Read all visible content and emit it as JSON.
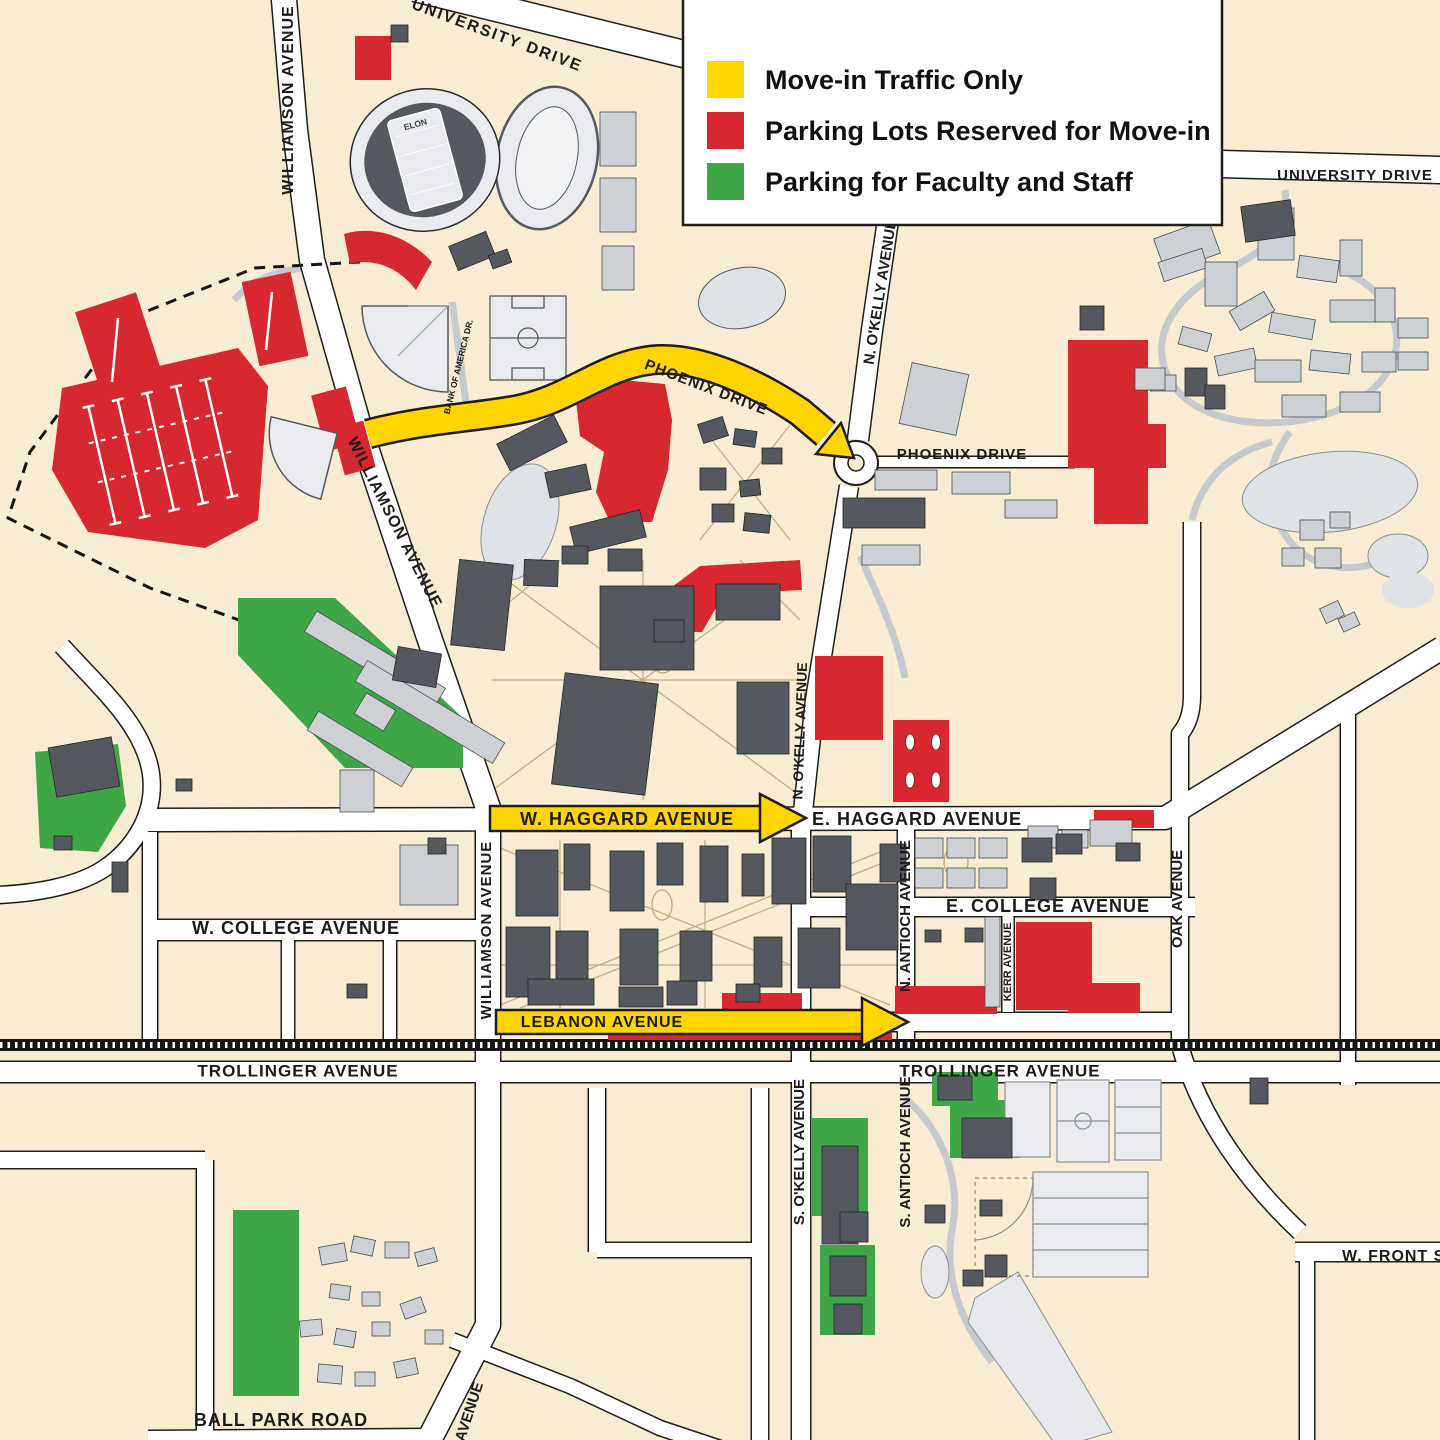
{
  "legend": {
    "items": [
      {
        "id": "move-in-traffic",
        "label": "Move-in Traffic Only",
        "color": "#FFD500"
      },
      {
        "id": "reserved-parking",
        "label": "Parking Lots Reserved for Move-in",
        "color": "#D7282F"
      },
      {
        "id": "faculty-staff-parking",
        "label": "Parking for Faculty and Staff",
        "color": "#3FA648"
      }
    ]
  },
  "colors": {
    "background": "#f8ecd2",
    "road": "#ffffff",
    "road_outline": "#1f1d1b",
    "building_dark": "#55585f",
    "building_light": "#cdd1d5",
    "field_light": "#e9ebee",
    "move_in_traffic": "#FFD500",
    "reserved_parking": "#D7282F",
    "faculty_staff_parking": "#3FA648",
    "railroad": "#161616"
  },
  "road_labels": {
    "university_drive_nw": "UNIVERSITY DRIVE",
    "university_drive_ne": "UNIVERSITY DRIVE",
    "williamson_avenue_n": "WILLIAMSON AVENUE",
    "williamson_avenue_mid": "WILLIAMSON AVENUE",
    "williamson_avenue_s": "WILLIAMSON AVENUE",
    "phoenix_drive_arrow": "PHOENIX DRIVE",
    "phoenix_drive_e": "PHOENIX DRIVE",
    "n_okelly_avenue_upper": "N. O'KELLY AVENUE",
    "n_okelly_avenue_lower": "N. O'KELLY AVENUE",
    "bank_of_america_dr": "BANK OF AMERICA DR.",
    "w_haggard_avenue": "W. HAGGARD AVENUE",
    "e_haggard_avenue": "E. HAGGARD AVENUE",
    "w_college_avenue": "W. COLLEGE AVENUE",
    "e_college_avenue": "E. COLLEGE AVENUE",
    "n_antioch_avenue": "N. ANTIOCH AVENUE",
    "kerr_avenue": "KERR AVENUE",
    "oak_avenue": "OAK AVENUE",
    "lebanon_avenue": "LEBANON AVENUE",
    "trollinger_avenue_w": "TROLLINGER AVENUE",
    "trollinger_avenue_e": "TROLLINGER AVENUE",
    "s_okelly_avenue": "S. O'KELLY AVENUE",
    "s_antioch_avenue": "S. ANTIOCH AVENUE",
    "w_front_street": "W. FRONT STREET",
    "ball_park_road": "BALL PARK ROAD",
    "avenue_partial": "AVENUE",
    "elon_field": "ELON"
  }
}
